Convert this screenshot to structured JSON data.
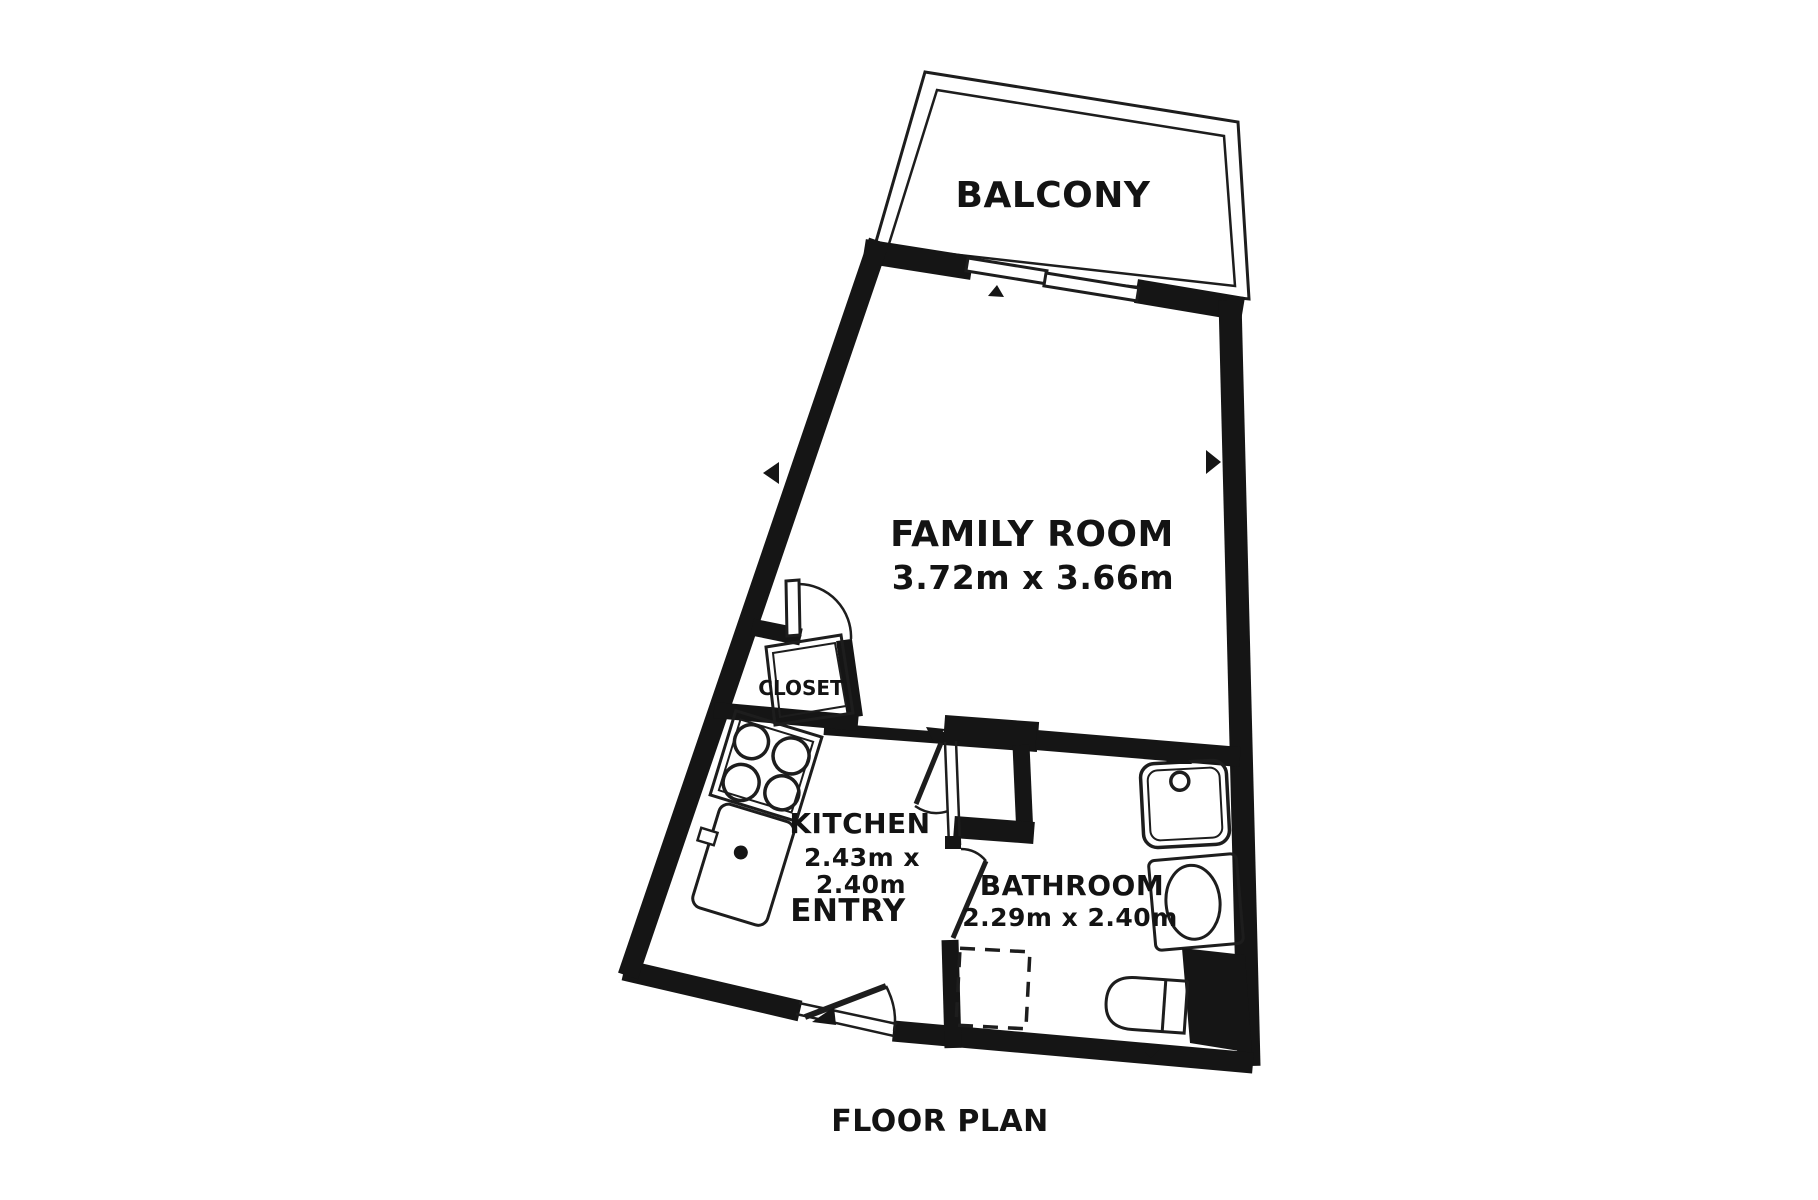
{
  "title": "FLOOR PLAN",
  "colors": {
    "wall": "#151515",
    "line": "#1d1d1d",
    "background": "#ffffff"
  },
  "rooms": {
    "balcony": {
      "label": "BALCONY"
    },
    "family_room": {
      "label": "FAMILY ROOM",
      "dimensions": "3.72m x 3.66m"
    },
    "closet": {
      "label": "CLOSET"
    },
    "kitchen": {
      "label": "KITCHEN",
      "dimensions_line1": "2.43m x",
      "dimensions_line2": "2.40m"
    },
    "entry": {
      "label": "ENTRY"
    },
    "bathroom": {
      "label": "BATHROOM",
      "dimensions": "2.29m x 2.40m"
    }
  },
  "fixtures": [
    "stove",
    "kitchen-sink",
    "bathroom-sink",
    "toilet",
    "bathtub",
    "shower-base-dashed",
    "balcony-sliding-door",
    "closet-door",
    "family-room-door",
    "bathroom-door",
    "entry-door"
  ]
}
